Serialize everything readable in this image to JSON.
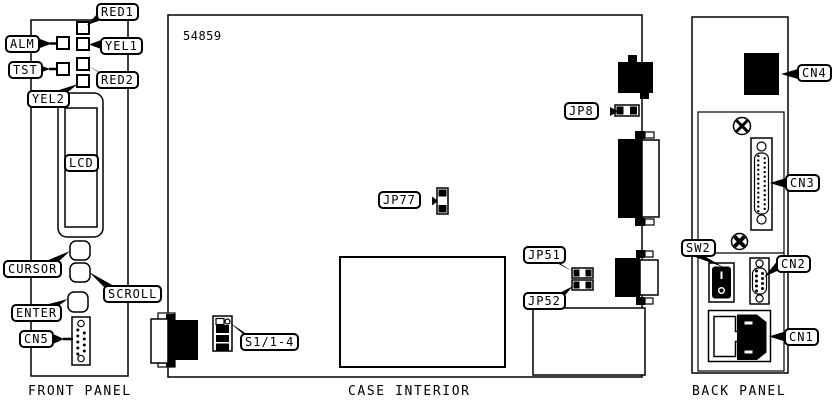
{
  "colors": {
    "line": "#000000",
    "background": "#ffffff"
  },
  "diagram": {
    "board_number": "54859",
    "sections": [
      {
        "title": "FRONT PANEL"
      },
      {
        "title": "CASE INTERIOR"
      },
      {
        "title": "BACK PANEL"
      }
    ],
    "callouts": {
      "red1": "RED1",
      "alm": "ALM",
      "yel1": "YEL1",
      "tst": "TST",
      "red2": "RED2",
      "yel2": "YEL2",
      "lcd": "LCD",
      "cursor": "CURSOR",
      "scroll": "SCROLL",
      "enter": "ENTER",
      "cn5": "CN5",
      "jp8": "JP8",
      "jp77": "JP77",
      "jp51": "JP51",
      "jp52": "JP52",
      "s1_1_4": "S1/1-4",
      "cn4": "CN4",
      "cn3": "CN3",
      "sw2": "SW2",
      "cn2": "CN2",
      "cn1": "CN1"
    }
  }
}
